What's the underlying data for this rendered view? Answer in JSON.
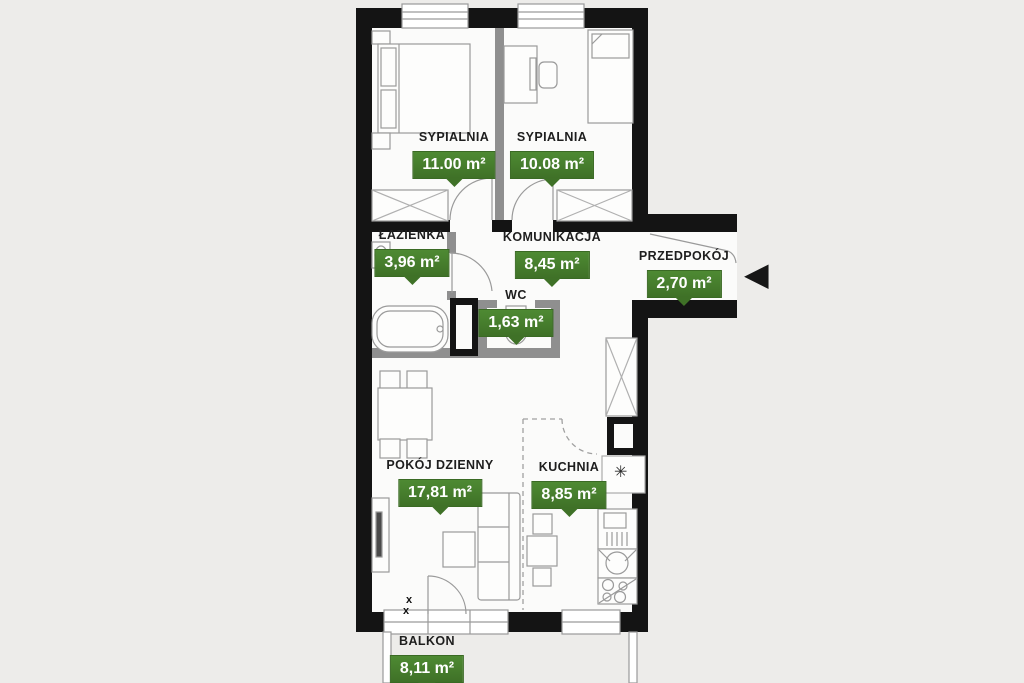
{
  "rooms": [
    {
      "label": "SYPIALNIA",
      "area": "11.00 m²"
    },
    {
      "label": "SYPIALNIA",
      "area": "10.08 m²"
    },
    {
      "label": "ŁAZIENKA",
      "area": "3,96 m²"
    },
    {
      "label": "KOMUNIKACJA",
      "area": "8,45 m²"
    },
    {
      "label": "WC",
      "area": "1,63 m²"
    },
    {
      "label": "PRZEDPOKÓJ",
      "area": "2,70 m²"
    },
    {
      "label": "POKÓJ DZIENNY",
      "area": "17,81 m²"
    },
    {
      "label": "KUCHNIA",
      "area": "8,85 m²"
    },
    {
      "label": "BALKON",
      "area": "8,11 m²"
    }
  ],
  "icons": {
    "entrance_arrow": "◀",
    "vent": "✳",
    "door_mark": "x"
  },
  "colors": {
    "badge_green_top": "#4e8a33",
    "badge_green_bottom": "#3f7127",
    "wall_black": "#141414",
    "partition_gray": "#8f8f8f",
    "background": "#edecea",
    "floor_white": "#fbfbfa"
  }
}
